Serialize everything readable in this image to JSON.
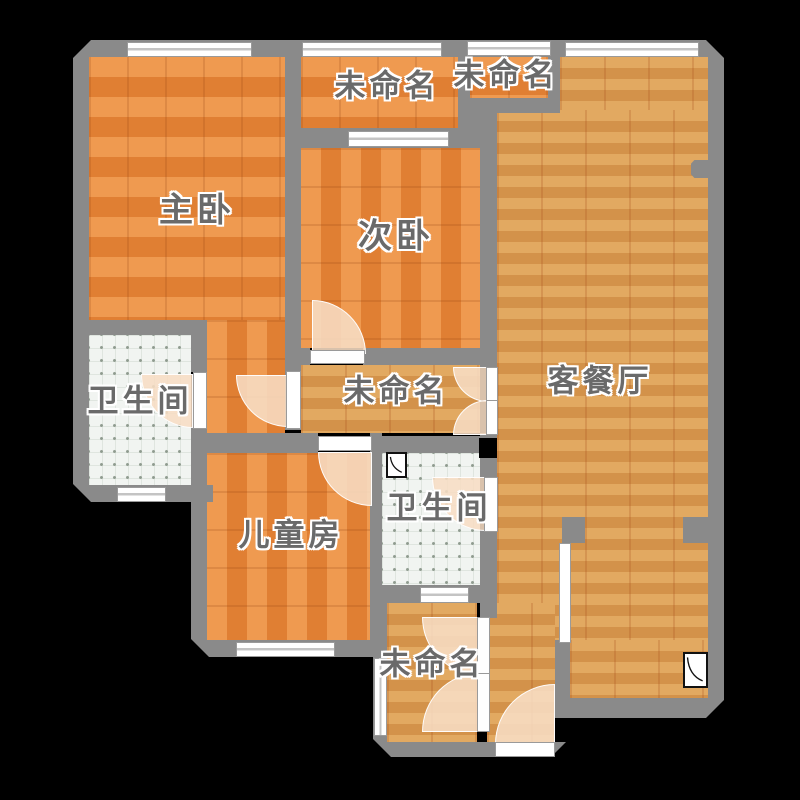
{
  "floorplan": {
    "rooms": {
      "master": {
        "label": "主卧"
      },
      "second": {
        "label": "次卧"
      },
      "living": {
        "label": "客餐厅"
      },
      "bathroom_main": {
        "label": "卫生间"
      },
      "bathroom_guest": {
        "label": "卫生间"
      },
      "kids": {
        "label": "儿童房"
      },
      "balcony_top": {
        "label": "未命名"
      },
      "nook_top": {
        "label": "未命名"
      },
      "hallway": {
        "label": "未命名"
      },
      "balcony_bottom": {
        "label": "未命名"
      }
    },
    "colors": {
      "background": "#000000",
      "wall": "#8a8a8a",
      "wood_orange_light": "#ef9a50",
      "wood_orange_dark": "#e07f33",
      "wood_gold_light": "#e2a961",
      "wood_gold_dark": "#d3924a",
      "tile": "#f1f4f1",
      "door_arc": "#f6ddc4",
      "shaft": "#000000",
      "label_text": "#6a6a6a"
    }
  }
}
